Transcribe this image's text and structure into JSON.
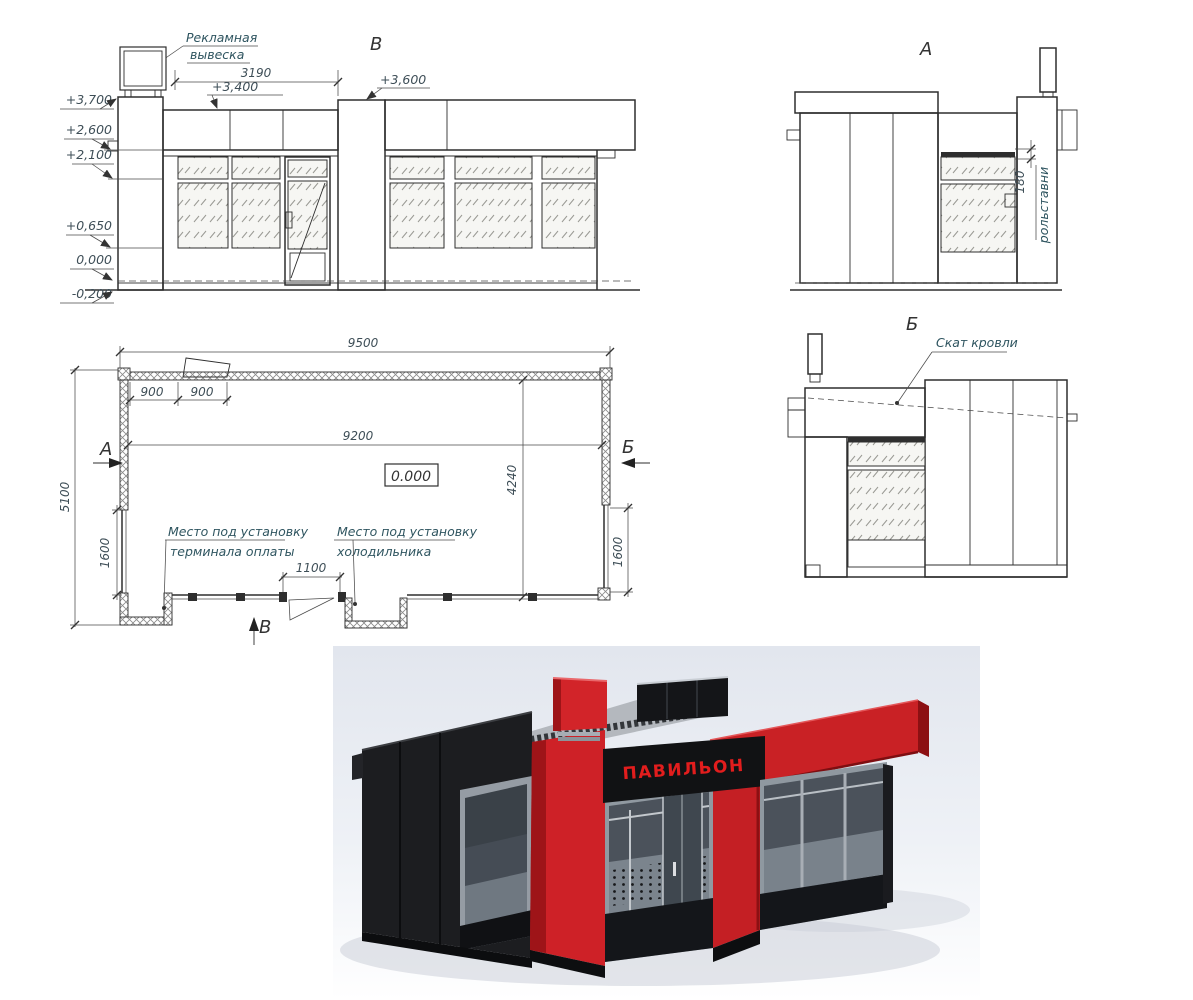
{
  "colors": {
    "accent_red": "#ce2127",
    "dark_red": "#8f1115",
    "panel_black": "#1c1d20",
    "drawing_line": "#2e2e2e",
    "annotation_text": "#2f5560",
    "sign_text_red": "#e21d1d",
    "render_bg_top": "#e2e6ee"
  },
  "front_elevation": {
    "label": "В",
    "callout_line1": "Рекламная",
    "callout_line2": "вывеска",
    "dim_3190": "3190",
    "mark_3400": "+3,400",
    "mark_3600": "+3,600",
    "levels": {
      "l1": "+3,700",
      "l2": "+2,600",
      "l3": "+2,100",
      "l4": "+0,650",
      "l5": "0,000",
      "l6": "-0,200"
    }
  },
  "side_a": {
    "label": "А",
    "dim_180": "180",
    "shutters": "рольставни"
  },
  "side_b": {
    "label": "Б",
    "roof_slope": "Скат кровли"
  },
  "plan": {
    "dim_9500": "9500",
    "dim_900_a": "900",
    "dim_900_b": "900",
    "dim_9200": "9200",
    "dim_4240": "4240",
    "dim_5100": "5100",
    "dim_1600_left": "1600",
    "dim_1600_right": "1600",
    "dim_1100": "1100",
    "level_mark": "0.000",
    "terminal_label_line1": "Место под установку",
    "terminal_label_line2": "терминала оплаты",
    "fridge_label_line1": "Место под установку",
    "fridge_label_line2": "холодильника",
    "section_a": "А",
    "section_b": "Б",
    "section_v": "В"
  },
  "render_3d": {
    "sign_text": "ПАВИЛЬОН"
  }
}
